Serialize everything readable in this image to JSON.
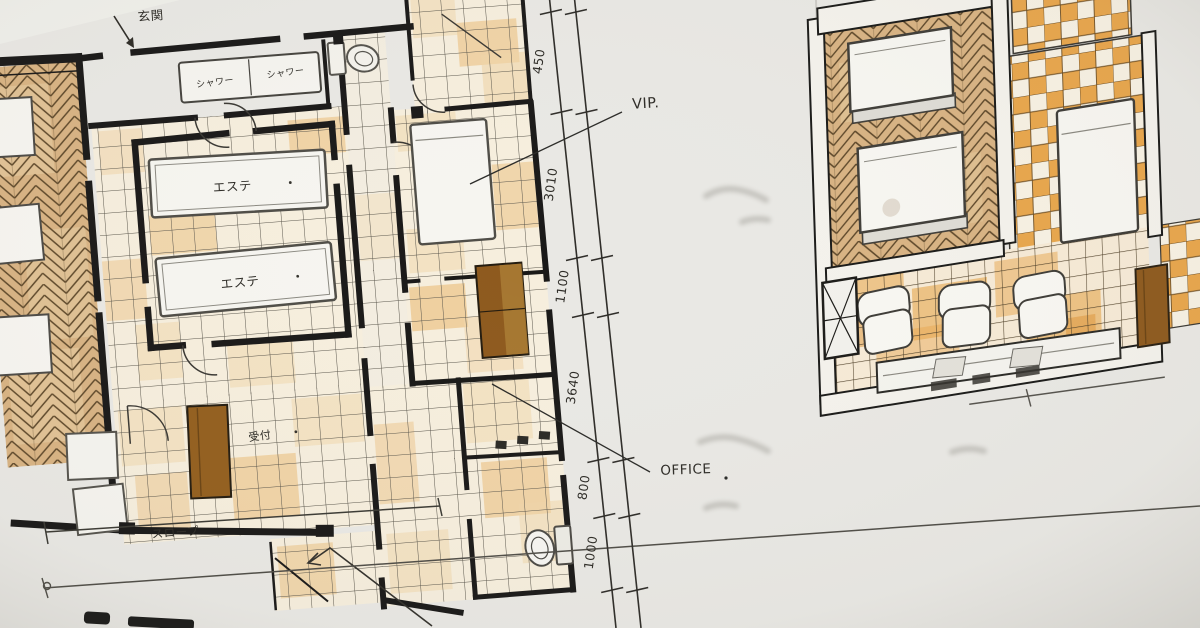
{
  "labels": {
    "entrance": "玄関",
    "shower": "シャワー",
    "esthe": "エステ",
    "reception": "受付",
    "slope": "スロープ",
    "vip": "VIP.",
    "office": "OFFICE"
  },
  "dimensions": {
    "chain": [
      "450",
      "3010",
      "1100",
      "3640",
      "800",
      "1000"
    ]
  },
  "palette": {
    "paper": "#e9e8e4",
    "wall_ink": "#1a1918",
    "pen_ink": "#33312c",
    "tile_base": "#f6eedd",
    "tile_patch_light": "#f0d6a9",
    "tile_patch_deep": "#e8b264",
    "tile_grid_line": "#5a564c",
    "wood_base": "#d8b383",
    "wood_ink": "#5d4729",
    "checker_orange": "#e8a64c",
    "furniture_brown": "#8e5a1e",
    "fixture_white": "#f7f6f1",
    "fixture_outline": "#4c4a45",
    "faint_grey": "#9b9a93"
  }
}
